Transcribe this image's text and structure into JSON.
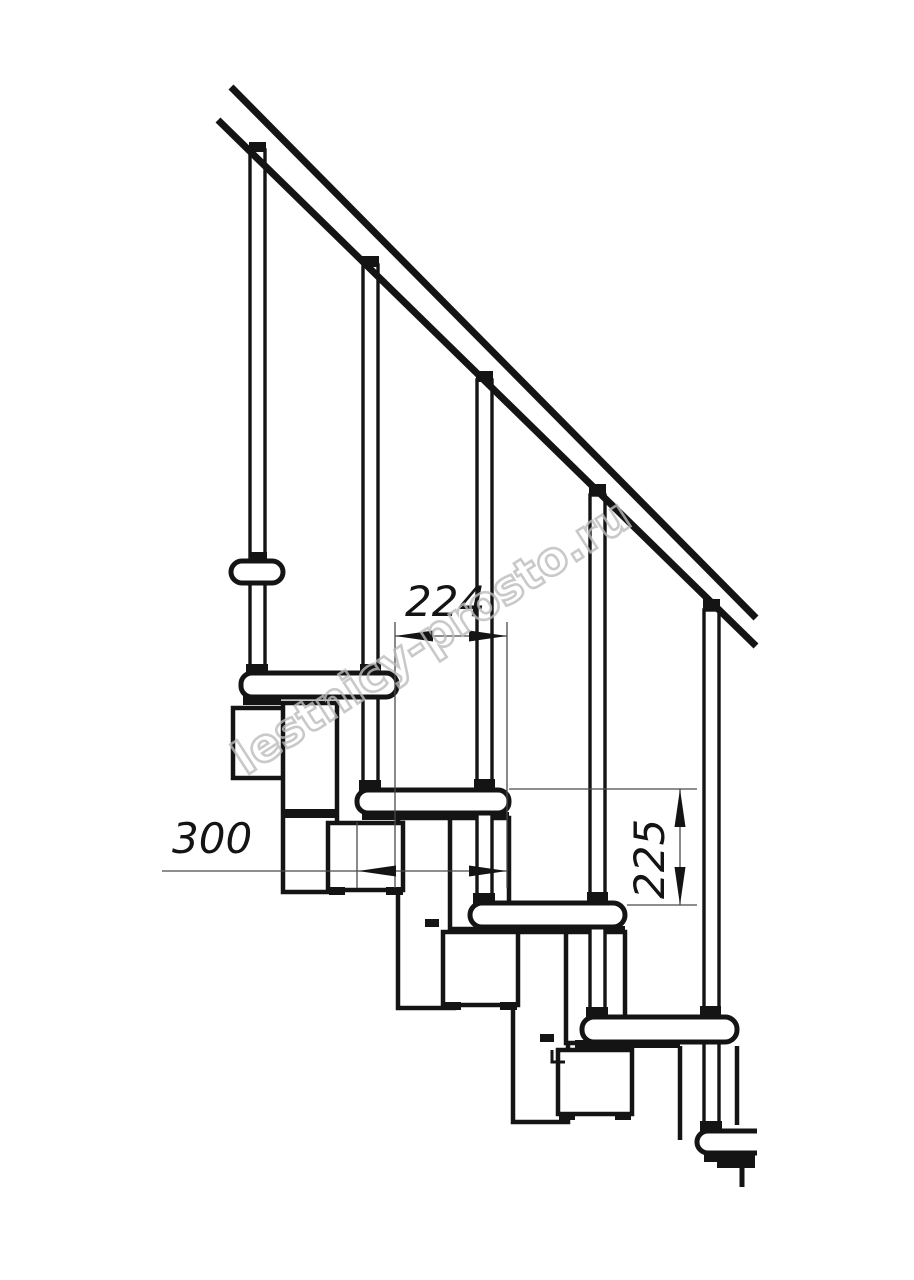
{
  "drawing": {
    "kind": "staircase-side-view-technical-drawing",
    "background_color": "#ffffff",
    "line_color": "#141414",
    "thin_line_color": "#4a4a4a",
    "watermark": {
      "text": "lestnicy-prosto.ru",
      "color": "#bcbcbc",
      "rotation_deg": -33
    },
    "dimensions": {
      "going": {
        "label": "224",
        "orientation": "horizontal"
      },
      "tread_depth": {
        "label": "300",
        "orientation": "horizontal"
      },
      "rise": {
        "label": "225",
        "orientation": "vertical"
      }
    },
    "components": {
      "handrail_count": 1,
      "baluster_count": 5,
      "tread_count": 6
    }
  }
}
